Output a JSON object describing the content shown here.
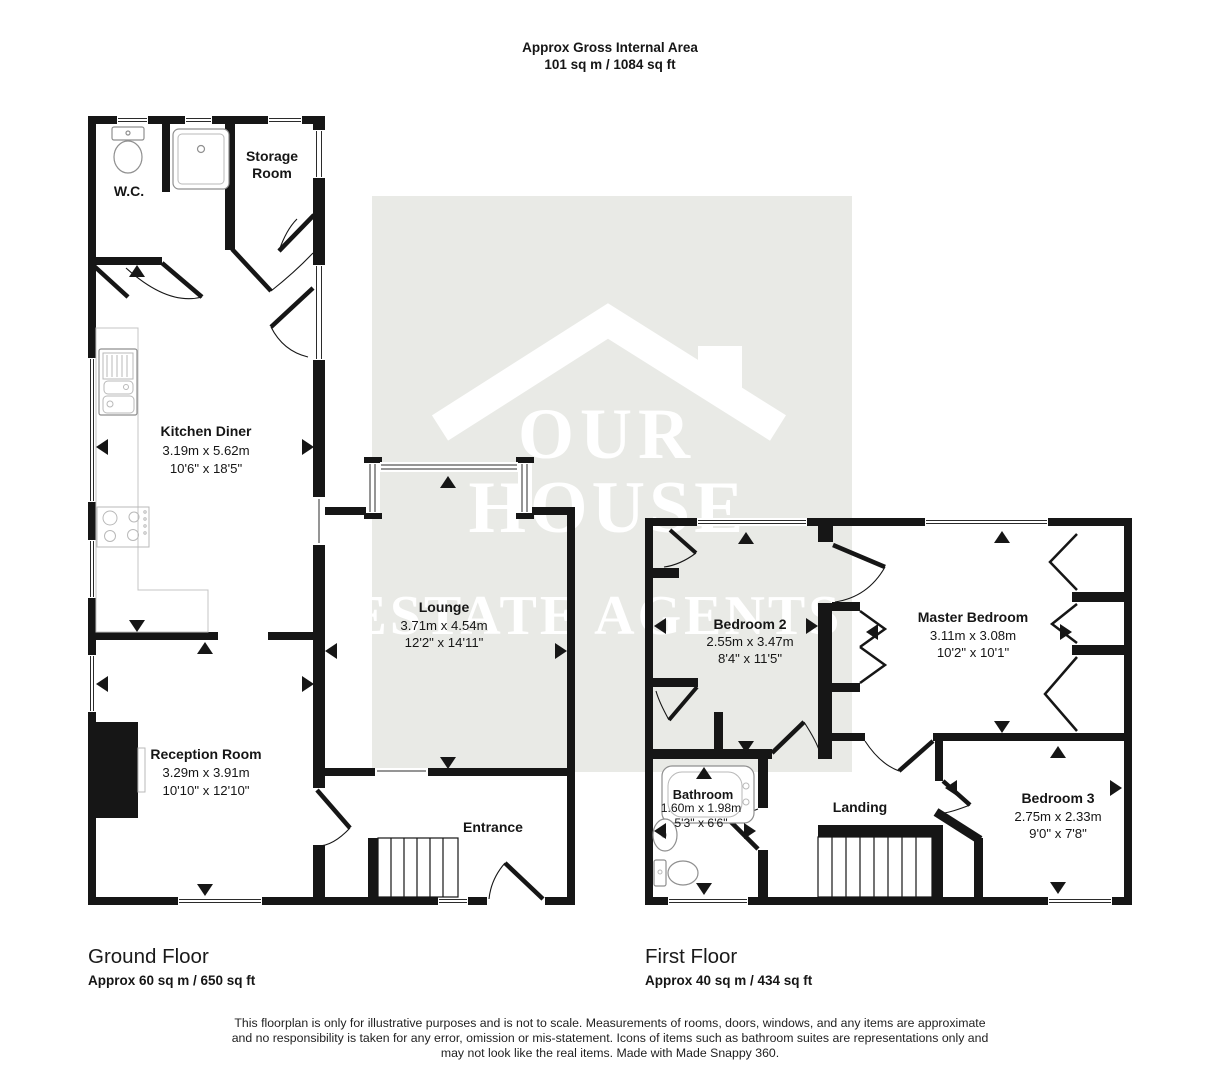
{
  "title": {
    "line1": "Approx Gross Internal Area",
    "line2": "101 sq m / 1084 sq ft"
  },
  "watermark": {
    "line1": "OUR",
    "line2": "HOUSE",
    "line3": "ESTATE AGENTS"
  },
  "rooms": {
    "wc": {
      "name": "W.C."
    },
    "storage": {
      "line1": "Storage",
      "line2": "Room"
    },
    "kitchen": {
      "name": "Kitchen Diner",
      "metric": "3.19m x 5.62m",
      "imperial": "10'6\" x 18'5\""
    },
    "lounge": {
      "name": "Lounge",
      "metric": "3.71m x 4.54m",
      "imperial": "12'2\" x 14'11\""
    },
    "reception": {
      "name": "Reception Room",
      "metric": "3.29m x 3.91m",
      "imperial": "10'10\" x 12'10\""
    },
    "entrance": {
      "name": "Entrance"
    },
    "bedroom2": {
      "name": "Bedroom 2",
      "metric": "2.55m x 3.47m",
      "imperial": "8'4\" x 11'5\""
    },
    "master": {
      "name": "Master Bedroom",
      "metric": "3.11m x 3.08m",
      "imperial": "10'2\" x 10'1\""
    },
    "bathroom": {
      "name": "Bathroom",
      "metric": "1.60m x 1.98m",
      "imperial": "5'3\" x 6'6\""
    },
    "landing": {
      "name": "Landing"
    },
    "bedroom3": {
      "name": "Bedroom 3",
      "metric": "2.75m x 2.33m",
      "imperial": "9'0\" x 7'8\""
    }
  },
  "floors": {
    "ground": {
      "name": "Ground Floor",
      "area": "Approx 60 sq m / 650 sq ft"
    },
    "first": {
      "name": "First Floor",
      "area": "Approx 40 sq m / 434 sq ft"
    }
  },
  "disclaimer": {
    "line1": "This floorplan is only for illustrative purposes and is not to scale. Measurements of rooms, doors, windows, and any items are approximate",
    "line2": "and no responsibility is taken for any error, omission or mis-statement. Icons of items such as bathroom suites are representations only and",
    "line3": "may not look like the real items. Made with Made Snappy 360."
  },
  "colors": {
    "wall": "#161616",
    "watermark_bg": "#e9eae6",
    "watermark_text": "#ffffff"
  }
}
